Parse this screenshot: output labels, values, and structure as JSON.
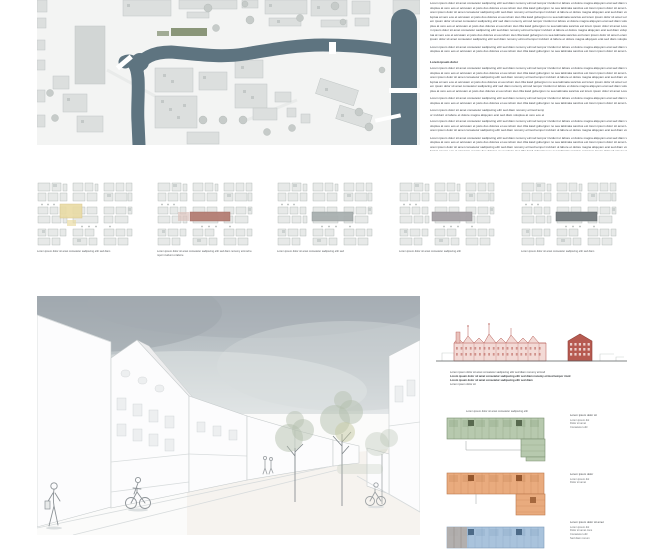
{
  "board": {
    "background": "#ffffff"
  },
  "site_plan": {
    "colors": {
      "water": "#5e7480",
      "land": "#f3f4f3",
      "building": "#dcdfde",
      "building_outline": "#c0c6c5",
      "building_dark": "#d2d6d5",
      "tree": "#c6cbc9",
      "green_roof": "#7e8c6c"
    }
  },
  "text_column": {
    "pool": "Lorem ipsum dolor sit amet consetetur sadipscing elitr sed diam nonumy eirmod tempor invidunt ut labore et dolore magna aliquyam erat sed diam voluptua at vero eos et accusam et justo duo dolores et ea rebum stet clita kasd gubergren no sea takimata sanctus est lorem ipsum dolor sit amet ",
    "blocks": [
      {
        "lines": 9,
        "gap": 0
      },
      {
        "lines": 2,
        "gap": 3
      },
      {
        "heading": true,
        "lines": 1,
        "gap": 6,
        "width": "38%"
      },
      {
        "lines": 6,
        "gap": 2
      },
      {
        "lines": 2,
        "gap": 3
      },
      {
        "lines": 2,
        "gap": 3,
        "width": "58%"
      },
      {
        "lines": 3,
        "gap": 2
      },
      {
        "lines": 6,
        "gap": 3
      },
      {
        "lines": 1,
        "gap": 2,
        "width": "82%"
      },
      {
        "lines": 2,
        "gap": 3
      }
    ]
  },
  "site_variants": {
    "items": [
      {
        "left": 0,
        "caption": "Lorem ipsum dolor sit amet consetetur sadipscing elitr sed diam",
        "caption_lines": 1,
        "highlights": [
          {
            "x": 23,
            "y": 22,
            "w": 22,
            "h": 14,
            "fill": "#e9dba4",
            "stroke": "#d6c183",
            "o": 0.9
          },
          {
            "x": 30,
            "y": 38,
            "w": 9,
            "h": 6,
            "fill": "#e9dba4",
            "o": 0.7
          }
        ]
      },
      {
        "left": 120,
        "caption": "Lorem ipsum dolor sit amet consetetur sadipscing elitr sed diam nonumy eirmod tempor invidunt ut labore",
        "caption_lines": 2,
        "highlights": [
          {
            "x": 33,
            "y": 30,
            "w": 40,
            "h": 9,
            "fill": "#b47d73",
            "stroke": "#9d655c",
            "o": 0.95
          },
          {
            "x": 21,
            "y": 30,
            "w": 11,
            "h": 9,
            "fill": "#dcc2bc",
            "o": 0.7
          }
        ]
      },
      {
        "left": 240,
        "caption": "Lorem ipsum dolor sit amet consetetur sadipscing elitr sed",
        "caption_lines": 1,
        "highlights": [
          {
            "x": 35,
            "y": 30,
            "w": 41,
            "h": 9,
            "fill": "#a9b0b0",
            "stroke": "#8e9595",
            "o": 0.95
          }
        ]
      },
      {
        "left": 362,
        "caption": "Lorem ipsum dolor sit amet consetetur sadipscing elitr",
        "caption_lines": 1,
        "highlights": [
          {
            "x": 33,
            "y": 30,
            "w": 40,
            "h": 9,
            "fill": "#a7a3a7",
            "stroke": "#8c888c",
            "o": 0.95
          }
        ]
      },
      {
        "left": 484,
        "caption": "Lorem ipsum dolor sit amet consetetur sadipscing elitr sed diam",
        "caption_lines": 1,
        "highlights": [
          {
            "x": 35,
            "y": 30,
            "w": 41,
            "h": 9,
            "fill": "#7a8184",
            "stroke": "#5f6669",
            "o": 1
          }
        ]
      }
    ]
  },
  "rendering": {
    "colors": {
      "sky_top": "#a7afb6",
      "sky_mid": "#c2c9cc",
      "sky_bottom": "#e6e9ea",
      "line": "#c7cccd",
      "foliage": "#b4bfae",
      "foliage2": "#c6c9a2",
      "ground": "#fbfbfa",
      "warm": "#f3efe7"
    }
  },
  "elevation": {
    "colors": {
      "line": "#b3554e",
      "fill": "#f3dad6",
      "roof": "#e9c2bc",
      "dark": "#b65a50",
      "ground": "#595c5e",
      "context": "#ccd1d0"
    },
    "caption_lines": [
      {
        "text": "Lorem ipsum dolor sit amet consetetur sadipscing elitr sed diam nonumy eirmod",
        "width": "86%",
        "bold": false
      },
      {
        "text": "Lorem ipsum dolor sit amet consetetur sadipscing elitr sed diam nonumy eirmod tempor invid",
        "width": "94%",
        "bold": true
      },
      {
        "text": "Lorem ipsum dolor sit amet consetetur sadipscing elitr sed diam",
        "width": "82%",
        "bold": true
      },
      {
        "text": "Lorem ipsum dolor sit",
        "width": "40%",
        "bold": false
      }
    ]
  },
  "unit_plans": {
    "items": [
      {
        "name": "floor-plan-upper-green",
        "shape": "L-right",
        "top": 8,
        "caption": "Lorem ipsum dolor sit amet consetetur sadipscing elitr",
        "fill": "#b7c9ae",
        "stroke": "#7b9071",
        "core": "#58694f",
        "legend": {
          "top": 6,
          "title": "Lorem ipsum dolor sit",
          "rows": [
            "Lorem ipsum dol",
            "Dolor sit amet",
            "Consetetur elitr"
          ]
        }
      },
      {
        "name": "floor-plan-mid-orange",
        "shape": "L-right-wide",
        "top": 63,
        "caption": "",
        "fill": "#e9ab7e",
        "stroke": "#bc7a4e",
        "core": "#94572e",
        "legend": {
          "top": 65,
          "title": "Lorem ipsum dolor",
          "rows": [
            "Lorem ipsum dol",
            "Dolor sit amet"
          ]
        }
      },
      {
        "name": "floor-plan-ground-blue",
        "shape": "bar-clipped",
        "top": 117,
        "caption": "",
        "fill": "#a9c3dc",
        "stroke": "#7d9cba",
        "core": "#4c6a87",
        "legend": {
          "top": 113,
          "title": "Lorem ipsum dolor sit amet",
          "rows": [
            "Lorem ipsum dol",
            "Dolor sit amet cons",
            "Consetetur elitr",
            "Sed diam nonum"
          ]
        }
      }
    ]
  }
}
